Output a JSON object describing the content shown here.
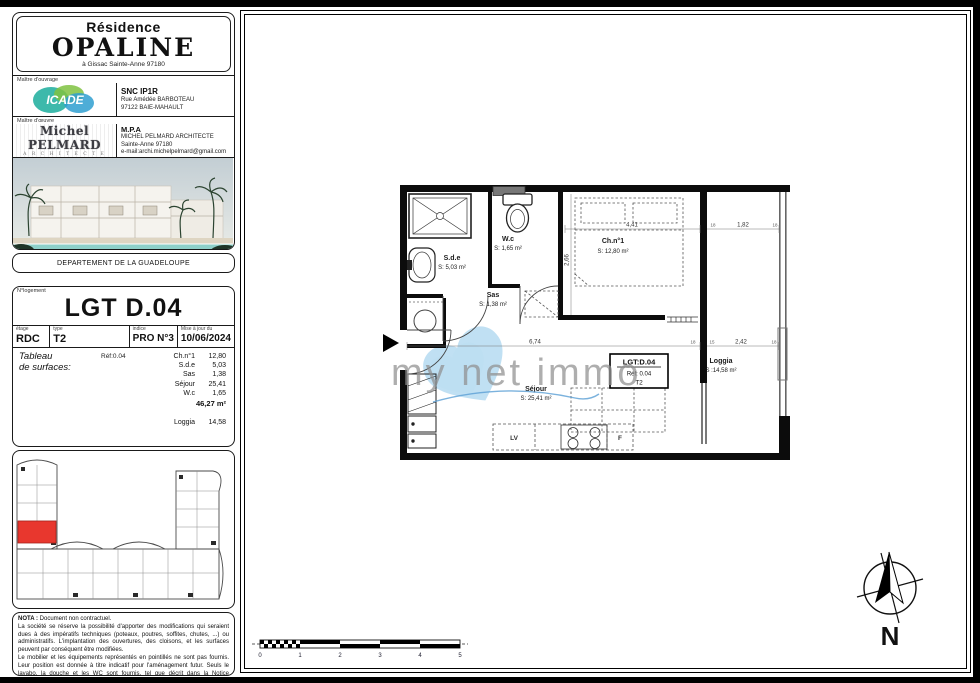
{
  "left_panel": {
    "header": {
      "residence": "Résidence",
      "name": "OPALINE",
      "address": "à Gissac Sainte-Anne 97180"
    },
    "ouvrage": {
      "section_label": "Maître d'ouvrage",
      "logo_text": "ICADE",
      "company": "SNC IP1R",
      "address_line1": "Rue Amédée BARBOTEAU",
      "address_line2": "97122 BAIE-MAHAULT"
    },
    "oeuvre": {
      "section_label": "Maître d'œuvre",
      "logo_line1": "Michel PELMARD",
      "logo_line2": "A R C H I T E C T E",
      "company": "M.P.A",
      "name": "MICHEL PELMARD ARCHITECTE",
      "address": "Sainte-Anne 97180",
      "email": "e-mail:archi.michelpelmard@gmail.com"
    },
    "photo_caption": "DEPARTEMENT DE LA GUADELOUPE",
    "lgt": {
      "section_label": "N°logement",
      "title": "LGT D.04",
      "etage_label": "étage",
      "etage": "RDC",
      "type_label": "type",
      "type": "T2",
      "indice_label": "indice",
      "indice": "PRO N°3",
      "date_label": "Mise à jour du",
      "date": "10/06/2024",
      "ref": "Réf:0.04",
      "surfaces_title_line1": "Tableau",
      "surfaces_title_line2": "de surfaces:",
      "surfaces": [
        {
          "name": "Ch.n°1",
          "value": "12,80"
        },
        {
          "name": "S.d.e",
          "value": "5,03"
        },
        {
          "name": "Sas",
          "value": "1,38"
        },
        {
          "name": "Séjour",
          "value": "25,41"
        },
        {
          "name": "W.c",
          "value": "1,65"
        }
      ],
      "total": "46,27 m²",
      "loggia_name": "Loggia",
      "loggia_value": "14,58"
    },
    "nota": {
      "title": "NOTA :",
      "intro": "Document non contractuel.",
      "p1": "La société se réserve la possibilité d'apporter des modifications qui seraient dues à des impératifs techniques (poteaux, poutres, soffites, chutes, ...) ou administratifs. L'implantation des ouvertures, des cloisons, et les surfaces peuvent par conséquent être modifiées.",
      "p2": "Le mobilier et les équipements représentés en pointillés ne sont pas fournis. Leur position est donnée à titre indicatif pour l'aménagement futur. Seuls le lavabo, la douche et les WC sont fournis, tel que décrit dans la Notice Descriptive Sommaire."
    }
  },
  "plan": {
    "rooms": [
      {
        "name": "S.d.e",
        "area": "S: 5,03 m²"
      },
      {
        "name": "W.c",
        "area": "S: 1,65 m²"
      },
      {
        "name": "Ch.n°1",
        "area": "S: 12,80 m²"
      },
      {
        "name": "Sas",
        "area": "S: 1,38 m²"
      },
      {
        "name": "Séjour",
        "area": "S: 25,41 m²"
      },
      {
        "name": "Loggia",
        "area": "S :14,58 m²"
      }
    ],
    "label_box": {
      "title": "LGT:D.04",
      "ref": "Réf: 0.04",
      "type": "T2"
    },
    "kitchen": {
      "dishwasher": "LV",
      "fridge": "F"
    },
    "dims": {
      "bedroom_width": "4,41",
      "loggia_top_width": "1,82",
      "bedroom_height": "2,66",
      "sejour_width": "6,74",
      "loggia_width": "2,42",
      "ticks": [
        "18",
        "18",
        "18",
        "15",
        "18"
      ]
    },
    "watermark": {
      "text": "my net immo"
    },
    "compass": {
      "label": "N"
    },
    "scale_bar": {
      "labels": [
        "0",
        "1",
        "2",
        "3",
        "4",
        "5"
      ]
    }
  },
  "colors": {
    "highlight_unit": "#e8372e",
    "watermark_heart": "#8cc7e9",
    "icade_teal": "#33b5a6"
  }
}
